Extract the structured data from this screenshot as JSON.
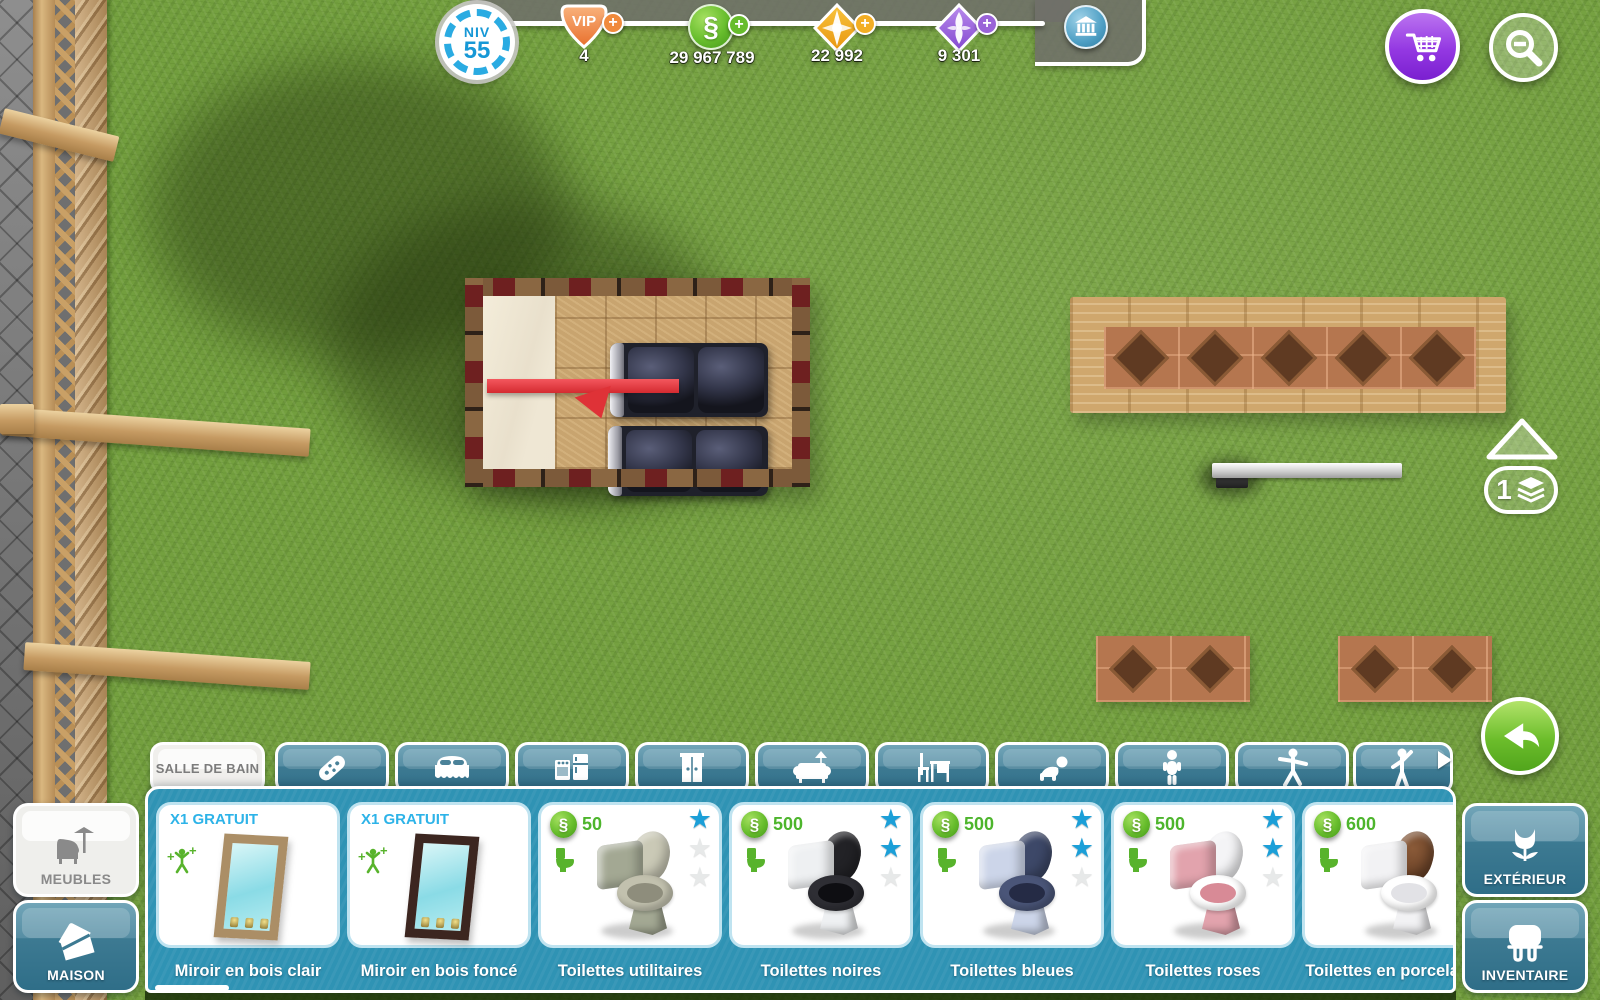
{
  "hud": {
    "level": {
      "label": "NIV",
      "value": "55"
    },
    "vip": {
      "label": "VIP",
      "value": "4",
      "color": "#ee7a3d"
    },
    "simoleons": {
      "value": "29 967 789",
      "color": "#67bd2c"
    },
    "social_points": {
      "value": "22 992",
      "color": "#f3ae24"
    },
    "lifestyle_points": {
      "value": "9 301",
      "color": "#9a63d8"
    },
    "bank_icon": "town-hall-icon",
    "cart_icon": "shopping-cart-icon",
    "zoom_out_icon": "magnifier-minus-icon",
    "floor_indicator": {
      "value": "1",
      "icon": "layers-icon",
      "up_icon": "triangle-up-icon"
    },
    "undo_icon": "curved-arrow-left-icon"
  },
  "shop": {
    "tabs": [
      {
        "label": "SALLE DE BAIN",
        "icon": null,
        "active": true
      },
      {
        "label": "",
        "icon": "remote-control-icon",
        "active": false
      },
      {
        "label": "",
        "icon": "bed-icon",
        "active": false
      },
      {
        "label": "",
        "icon": "kitchen-appliances-icon",
        "active": false
      },
      {
        "label": "",
        "icon": "wardrobe-icon",
        "active": false
      },
      {
        "label": "",
        "icon": "sofa-lamp-icon",
        "active": false
      },
      {
        "label": "",
        "icon": "desk-chair-icon",
        "active": false
      },
      {
        "label": "",
        "icon": "crawling-baby-icon",
        "active": false
      },
      {
        "label": "",
        "icon": "toddler-icon",
        "active": false
      },
      {
        "label": "",
        "icon": "preteen-icon",
        "active": false
      },
      {
        "label": "",
        "icon": "adult-icon",
        "active": false
      }
    ],
    "items": [
      {
        "badge": "X1 GRATUIT",
        "price": "",
        "name": "Miroir en bois clair",
        "reward_icon": "xp-figure-icon",
        "stars_filled": 0,
        "stars_total": 0
      },
      {
        "badge": "X1 GRATUIT",
        "price": "",
        "name": "Miroir en bois foncé",
        "reward_icon": "xp-figure-icon",
        "stars_filled": 0,
        "stars_total": 0
      },
      {
        "badge": "",
        "price": "50",
        "name": "Toilettes utilitaires",
        "need_icon": "toilet-need-icon",
        "stars_filled": 1,
        "stars_total": 3
      },
      {
        "badge": "",
        "price": "500",
        "name": "Toilettes noires",
        "need_icon": "toilet-need-icon",
        "stars_filled": 2,
        "stars_total": 3
      },
      {
        "badge": "",
        "price": "500",
        "name": "Toilettes bleues",
        "need_icon": "toilet-need-icon",
        "stars_filled": 2,
        "stars_total": 3
      },
      {
        "badge": "",
        "price": "500",
        "name": "Toilettes roses",
        "need_icon": "toilet-need-icon",
        "stars_filled": 2,
        "stars_total": 3
      },
      {
        "badge": "",
        "price": "600",
        "name": "Toilettes en porcelaine",
        "need_icon": "toilet-need-icon",
        "stars_filled": 2,
        "stars_total": 3
      }
    ],
    "buttons": {
      "meubles": "MEUBLES",
      "maison": "MAISON",
      "exterieur": "EXTÉRIEUR",
      "inventaire": "INVENTAIRE"
    },
    "colors": {
      "panel_teal": "#2f93b4",
      "tab_teal": "#3d7a92",
      "star_blue": "#1b9fd8",
      "price_green": "#4db52c",
      "badge_blue": "#2db3e8"
    }
  }
}
